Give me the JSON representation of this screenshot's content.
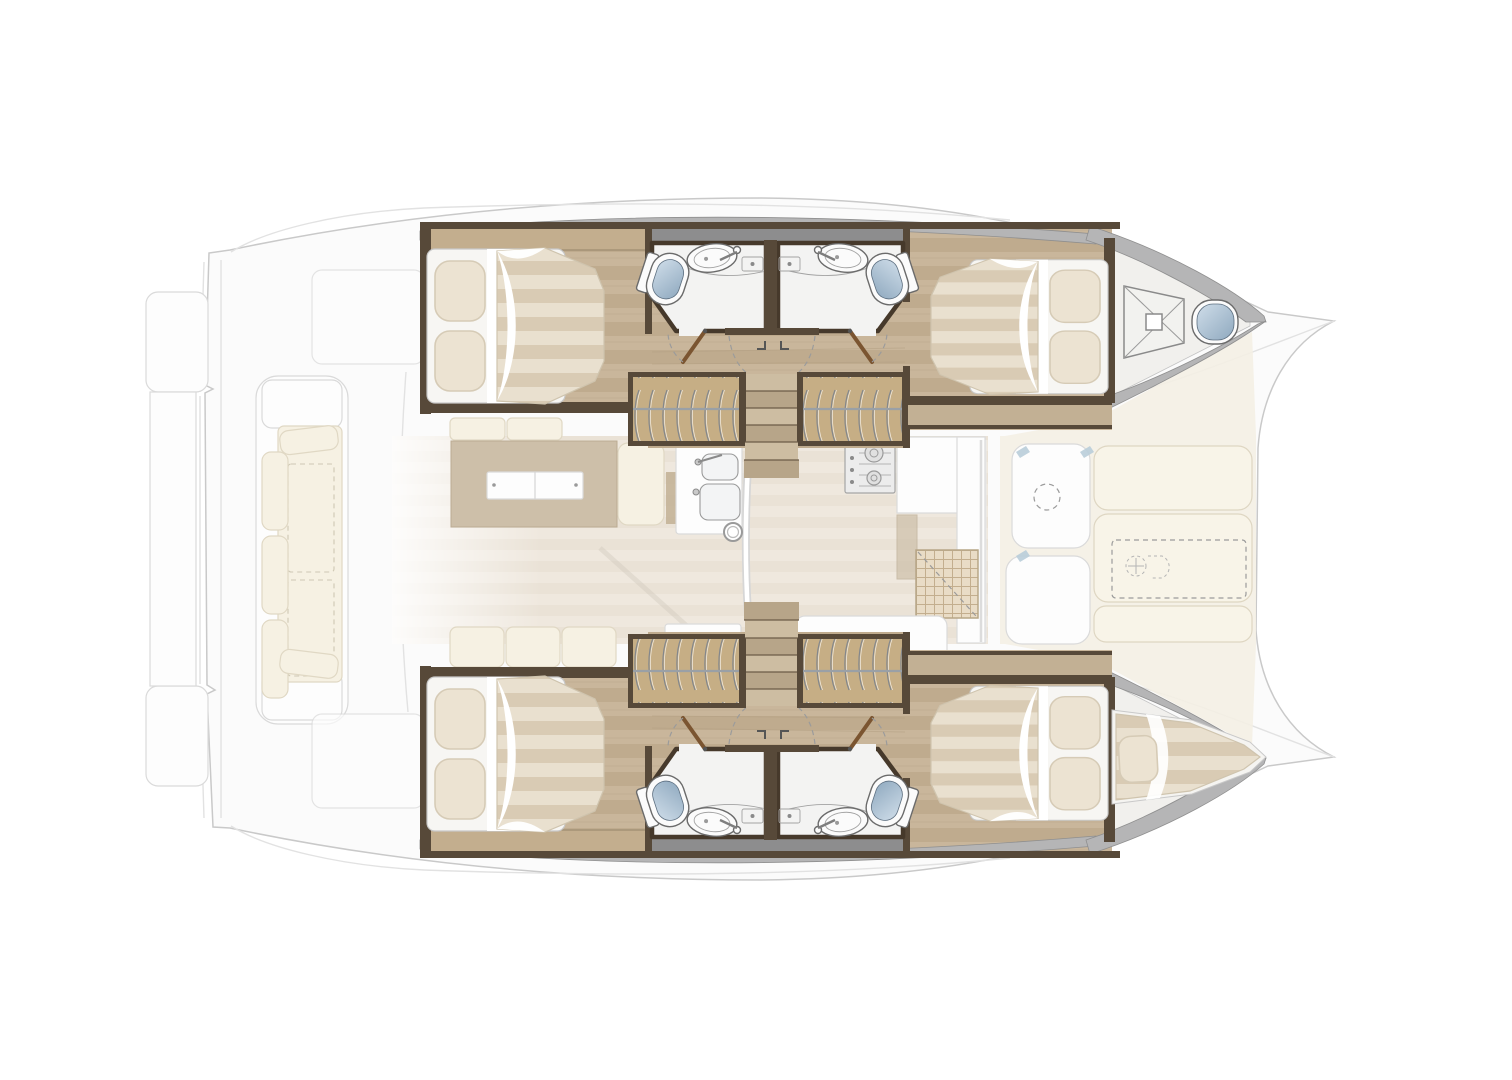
{
  "plan": {
    "type": "boat-floor-plan",
    "vessel": "catamaran",
    "view": "overhead interior layout",
    "description": "Overhead interior floor plan of a sailing catamaran: four double cabins and four bathrooms in the two hulls, central saloon with table and galley, aft cockpit bench, foredeck sun pads, forepeak deck hatch and single forepeak berth.",
    "inventory": {
      "hulls": 2,
      "double_cabins": 4,
      "bathrooms": 4,
      "toilets": 5,
      "bathroom_sinks": 4,
      "wardrobes": 4,
      "companionway_stairs": 2,
      "forepeak_berths": 1,
      "deck_hatches": 1,
      "saloon_tables": 1,
      "galley_sink_basins": 2,
      "stove_burners": 2,
      "cockpit_bench_seats": 1,
      "foredeck_sun_pads": 3
    }
  },
  "palette": {
    "page_bg": "#ffffff",
    "ghost_fill": "#fbfbfb",
    "ghost_stroke": "#c9c9c9",
    "ghost_line": "#e2e2e2",
    "ghost_wood": "#cdbfa9",
    "ghost_cushion": "#f6f1e3",
    "ghost_cushion_stroke": "#e0d8c4",
    "ghost_pad": "#f8f4e8",
    "ghost_pad_stroke": "#ded6c2",
    "foredeck_beige": "#f4f0e4",
    "saloon_floor_a": "#efe8de",
    "saloon_floor_b": "#eae2d6",
    "wood_a": "#c9b69b",
    "wood_b": "#bfab8e",
    "wood_grain": "#b29f82",
    "wood_dark": "#574939",
    "wood_band": "#c3ae8e",
    "wood_shelf": "#c2b094",
    "roof_band": "#8d8d8e",
    "wardrobe_fill": "#c6ae85",
    "step_a": "#cdbda2",
    "step_b": "#b7a589",
    "step_edge": "#6d5c47",
    "bath_floor": "#f3f3f2",
    "bath_wall": "#46392b",
    "porcelain": "#fbfbfb",
    "fixture_stroke": "#6b6b6b",
    "toilet_light": "#cfdde9",
    "toilet_dark": "#8fa9bf",
    "duvet_a": "#e9e0cf",
    "duvet_b": "#d9cbb4",
    "duvet_edge": "#cfc4ae",
    "pillow_fill": "#ece3d2",
    "pillow_stroke": "#d6cbb6",
    "mattress_fill": "#f7f6f3",
    "mattress_stroke": "#c8c8c8",
    "gunwale": "#b5b5b6",
    "gunwale_stroke": "#8f8f8f",
    "door_wood": "#7b5531",
    "dash_gray": "#9b9b9b",
    "accent_blue": "#b9cdd9"
  }
}
